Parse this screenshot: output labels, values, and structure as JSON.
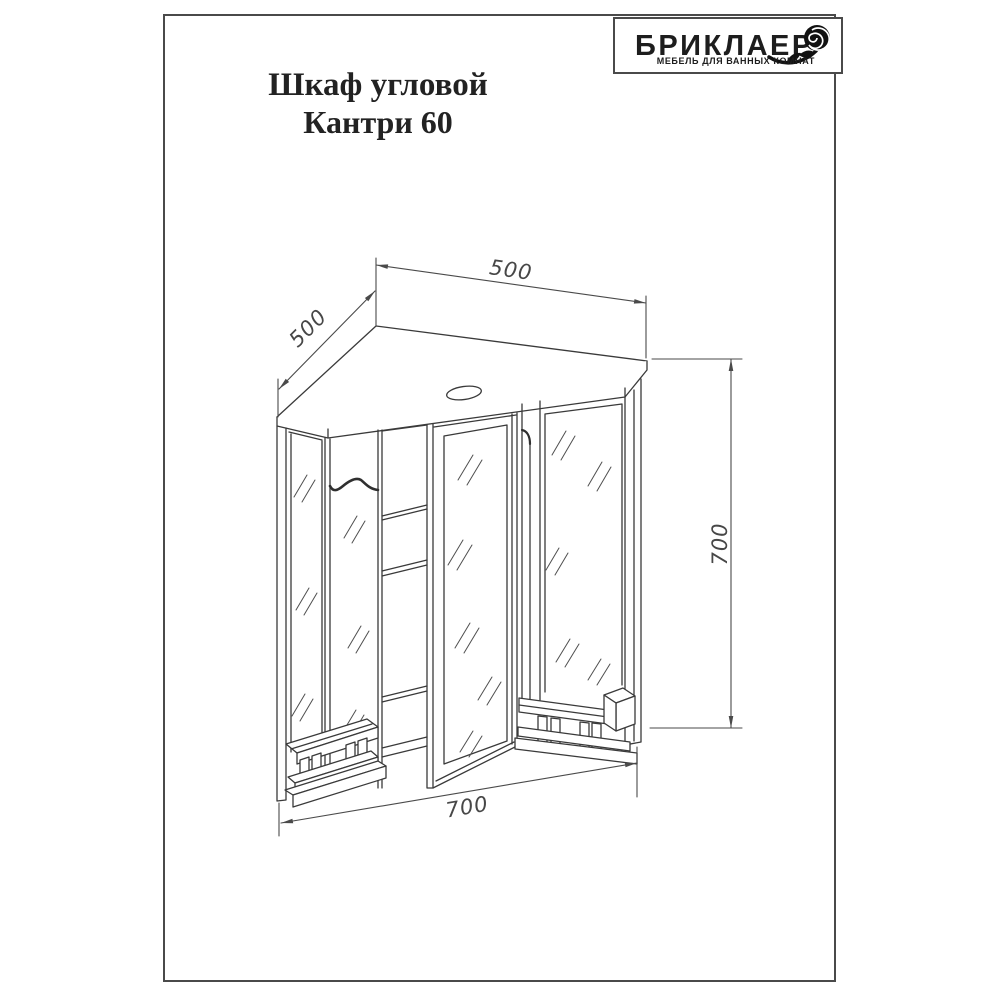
{
  "logo": {
    "brand": "БРИКЛАЕР",
    "tagline": "МЕБЕЛЬ ДЛЯ ВАННЫХ КОМНАТ",
    "icon": "rose-icon"
  },
  "title": {
    "line1": "Шкаф угловой",
    "line2": "Кантри 60"
  },
  "drawing": {
    "subject": "corner mirror cabinet isometric technical drawing",
    "dimensions": {
      "left_depth": "500",
      "top_width": "500",
      "height": "700",
      "front_width": "700"
    }
  },
  "colors": {
    "line": "#3a3a3a",
    "dim_line": "#4a4a4a",
    "frame": "#4a4a4a",
    "background": "#ffffff"
  }
}
